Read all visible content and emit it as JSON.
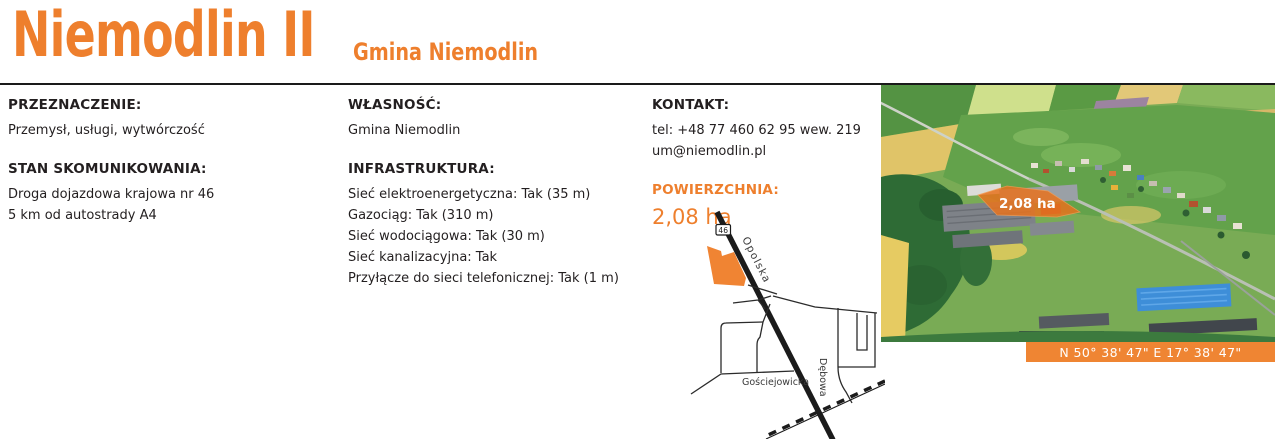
{
  "page": {
    "title": "Niemodlin II",
    "subtitle": "Gmina Niemodlin"
  },
  "sections": {
    "przeznaczenie": {
      "label": "PRZEZNACZENIE:",
      "value": "Przemysł, usługi, wytwórczość"
    },
    "stan_skomunikowania": {
      "label": "STAN SKOMUNIKOWANIA:",
      "lines": [
        "Droga dojazdowa krajowa nr 46",
        "5 km od autostrady A4"
      ]
    },
    "wlasnosc": {
      "label": "WŁASNOŚĆ:",
      "value": "Gmina Niemodlin"
    },
    "infrastruktura": {
      "label": "INFRASTRUKTURA:",
      "lines": [
        "Sieć elektroenergetyczna: Tak (35 m)",
        "Gazociąg: Tak (310 m)",
        "Sieć wodociągowa: Tak (30 m)",
        "Sieć kanalizacyjna: Tak",
        "Przyłącze do sieci telefonicznej: Tak (1 m)"
      ]
    },
    "kontakt": {
      "label": "KONTAKT:",
      "lines": [
        "tel: +48 77 460 62 95 wew. 219",
        "um@niemodlin.pl"
      ]
    },
    "powierzchnia": {
      "label": "POWIERZCHNIA:",
      "value": "2,08 ha"
    }
  },
  "map": {
    "road_number": "46",
    "street_opolska": "Opolska",
    "street_gosciejowicka": "Gościejowicka",
    "street_debowa": "Dębowa"
  },
  "photo": {
    "area_label": "2,08 ha",
    "coordinates": "N 50° 38' 47\" E 17° 38' 47\""
  },
  "colors": {
    "accent_orange": "#EE7F2D",
    "bar_orange": "#EF8533",
    "parcel_orange": "#E8731E",
    "text_dark": "#231F20"
  }
}
